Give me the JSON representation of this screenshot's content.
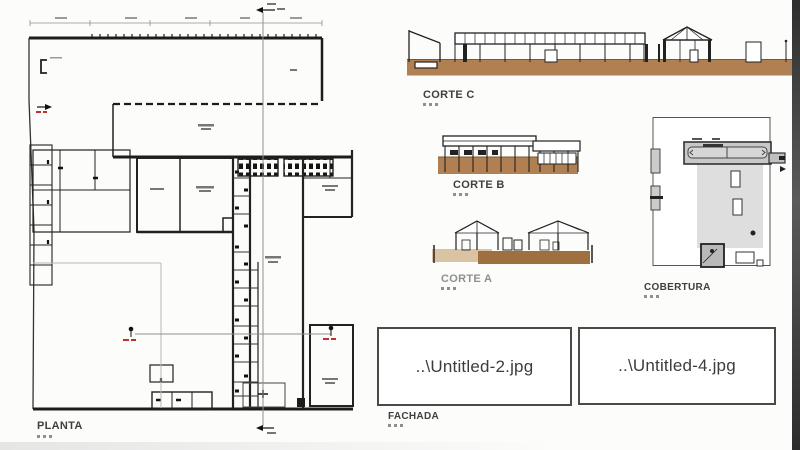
{
  "drawings": {
    "planta": {
      "label": "PLANTA"
    },
    "corte_a": {
      "label": "CORTE A"
    },
    "corte_b": {
      "label": "CORTE B"
    },
    "corte_c": {
      "label": "CORTE C"
    },
    "cobertura": {
      "label": "COBERTURA"
    },
    "fachada": {
      "label": "FACHADA"
    }
  },
  "image_placeholders": [
    {
      "filename": "..\\Untitled-2.jpg"
    },
    {
      "filename": "..\\Untitled-4.jpg"
    }
  ],
  "colors": {
    "ground_brown": "#b08052",
    "ground_light": "#d9c3a2",
    "ground_dark": "#a06f3f",
    "roof_slab_gray": "#c8c8c8",
    "roof_area_gray": "#dedede",
    "section_marker_red": "#c03030",
    "line_dark": "#1c1c1c",
    "edge_strip": "#3d3d3d"
  }
}
